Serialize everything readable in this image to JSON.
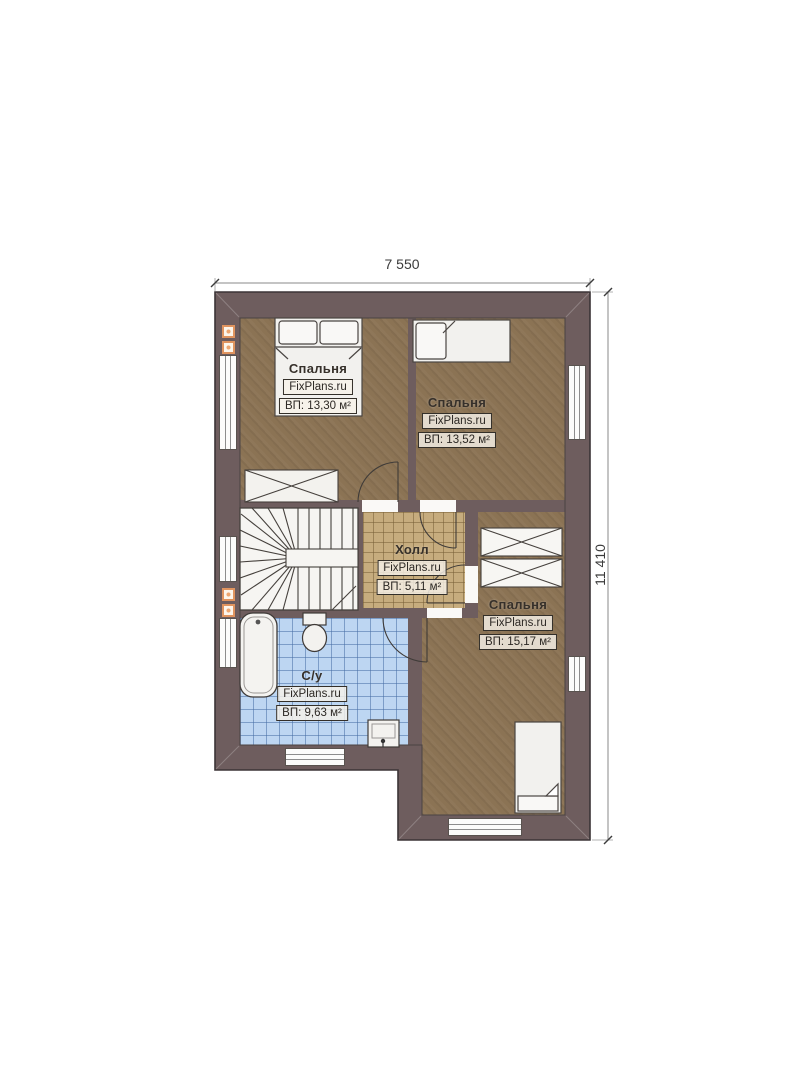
{
  "plan": {
    "type": "floor-plan",
    "branding": "FixPlans.ru",
    "dimensions": {
      "width_label": "7 550",
      "height_label": "11 410"
    },
    "rooms": [
      {
        "name": "Спальня",
        "brand": "FixPlans.ru",
        "area": "ВП: 13,30 м²"
      },
      {
        "name": "Спальня",
        "brand": "FixPlans.ru",
        "area": "ВП: 13,52 м²"
      },
      {
        "name": "Холл",
        "brand": "FixPlans.ru",
        "area": "ВП: 5,11 м²"
      },
      {
        "name": "Спальня",
        "brand": "FixPlans.ru",
        "area": "ВП: 15,17 м²"
      },
      {
        "name": "С/у",
        "brand": "FixPlans.ru",
        "area": "ВП: 9,63 м²"
      }
    ],
    "colors": {
      "wall": "#6e5d5e",
      "bedroom_floor": "#8b7354",
      "hall_floor": "#c6ac7e",
      "bath_floor": "#bdd6f2",
      "furniture": "#f2f1ee",
      "vent_accent": "#e0945f",
      "background": "#ffffff"
    }
  }
}
